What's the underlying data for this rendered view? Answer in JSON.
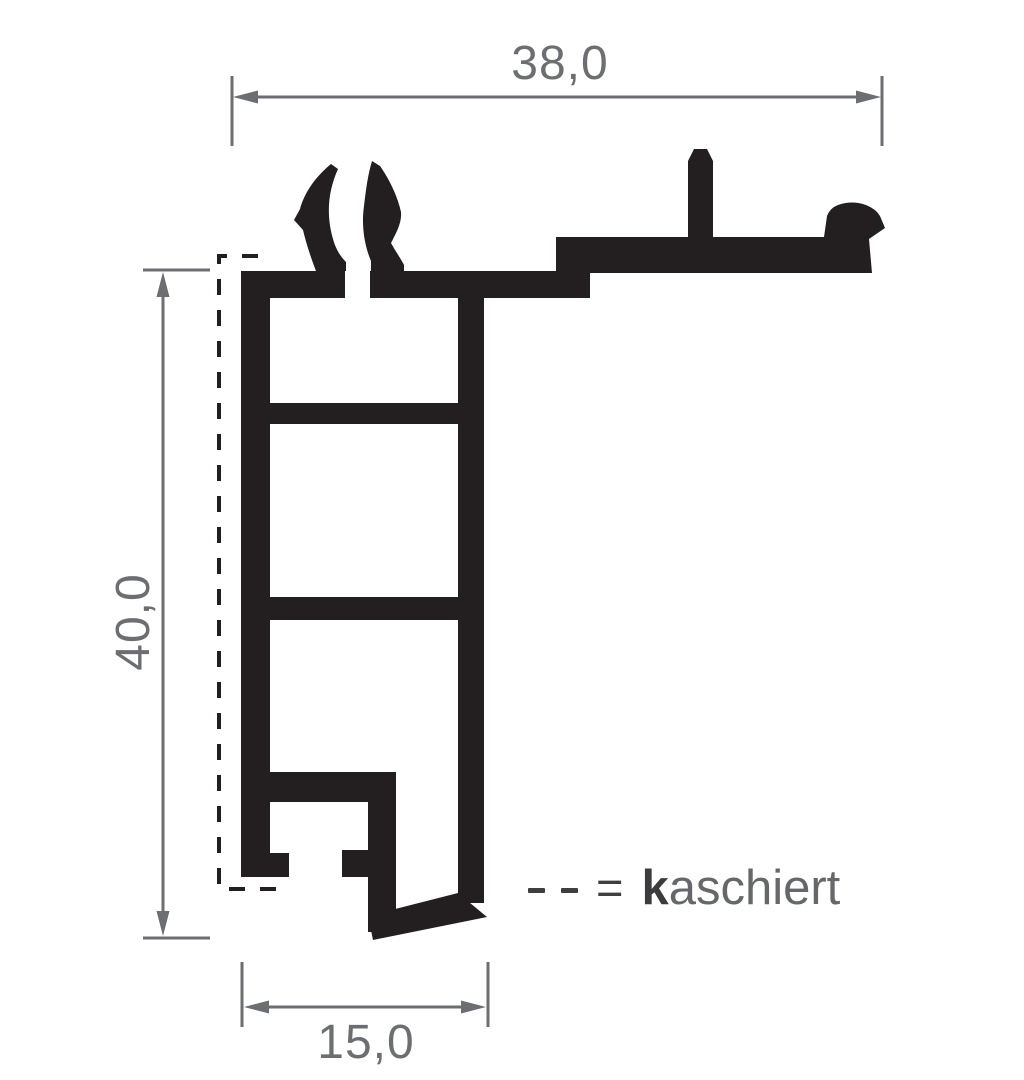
{
  "dimensions": {
    "top_width": "38,0",
    "left_height": "40,0",
    "bottom_width": "15,0"
  },
  "legend": {
    "equals_sign": "=",
    "term_bold_prefix": "k",
    "term_remainder": "aschiert"
  },
  "colors": {
    "profile": "#231f20",
    "dimension_gray": "#6d6e71",
    "legend_dark": "#3f3f41",
    "background": "#ffffff"
  }
}
